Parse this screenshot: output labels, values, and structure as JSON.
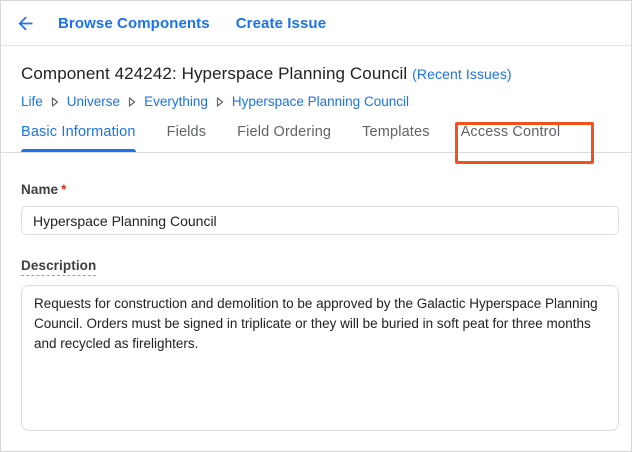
{
  "topbar": {
    "back_icon": "arrow-back",
    "links": [
      {
        "label": "Browse Components"
      },
      {
        "label": "Create Issue"
      }
    ]
  },
  "header": {
    "title": "Component 424242: Hyperspace Planning Council",
    "recent_issues_link": "(Recent Issues)"
  },
  "breadcrumb": {
    "items": [
      {
        "label": "Life"
      },
      {
        "label": "Universe"
      },
      {
        "label": "Everything"
      },
      {
        "label": "Hyperspace Planning Council"
      }
    ]
  },
  "tabs": [
    {
      "label": "Basic Information",
      "active": true
    },
    {
      "label": "Fields",
      "active": false
    },
    {
      "label": "Field Ordering",
      "active": false
    },
    {
      "label": "Templates",
      "active": false
    },
    {
      "label": "Access Control",
      "active": false,
      "highlighted": true
    }
  ],
  "form": {
    "name": {
      "label": "Name",
      "required_marker": "*",
      "value": "Hyperspace Planning Council"
    },
    "description": {
      "label": "Description",
      "value": "Requests for construction and demolition to be approved by the Galactic Hyperspace Planning Council. Orders must be signed in triplicate or they will be buried in soft peat for three months and recycled as firelighters."
    }
  },
  "colors": {
    "link_blue": "#1a73e8",
    "active_tab_blue": "#1a73e8",
    "inactive_tab_gray": "#5f6368",
    "title_text": "#202124",
    "label_text": "#3c4043",
    "required_red": "#d93025",
    "input_border": "#dadce0",
    "highlight_box_red": "#f4511e"
  }
}
